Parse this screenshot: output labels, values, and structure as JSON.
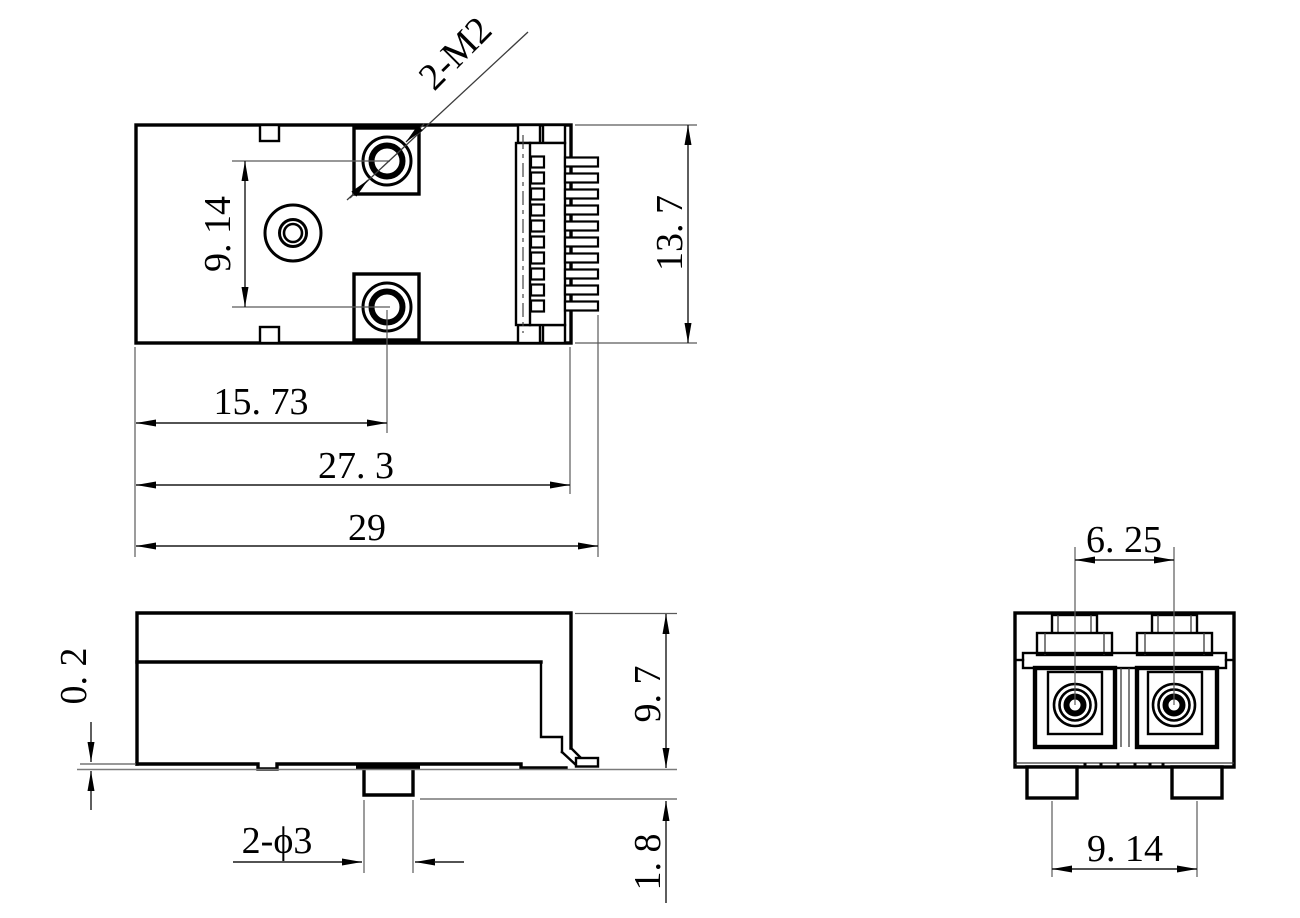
{
  "drawing": {
    "background": "#ffffff",
    "line_color": "#000000",
    "views": {
      "top": {
        "pin_count": 10,
        "dims": {
          "thread_callout": "2-M2",
          "hole_pitch": "9. 14",
          "width": "13. 7",
          "hole_offset": "15. 73",
          "body_length": "27. 3",
          "overall_length": "29"
        }
      },
      "side": {
        "serration_count": 6,
        "dims": {
          "standoff": "0. 2",
          "height": "9. 7",
          "peg_callout": "2-ϕ3",
          "peg_depth": "1. 8"
        }
      },
      "front": {
        "dims": {
          "port_pitch": "6. 25",
          "peg_pitch": "9. 14"
        }
      }
    }
  }
}
